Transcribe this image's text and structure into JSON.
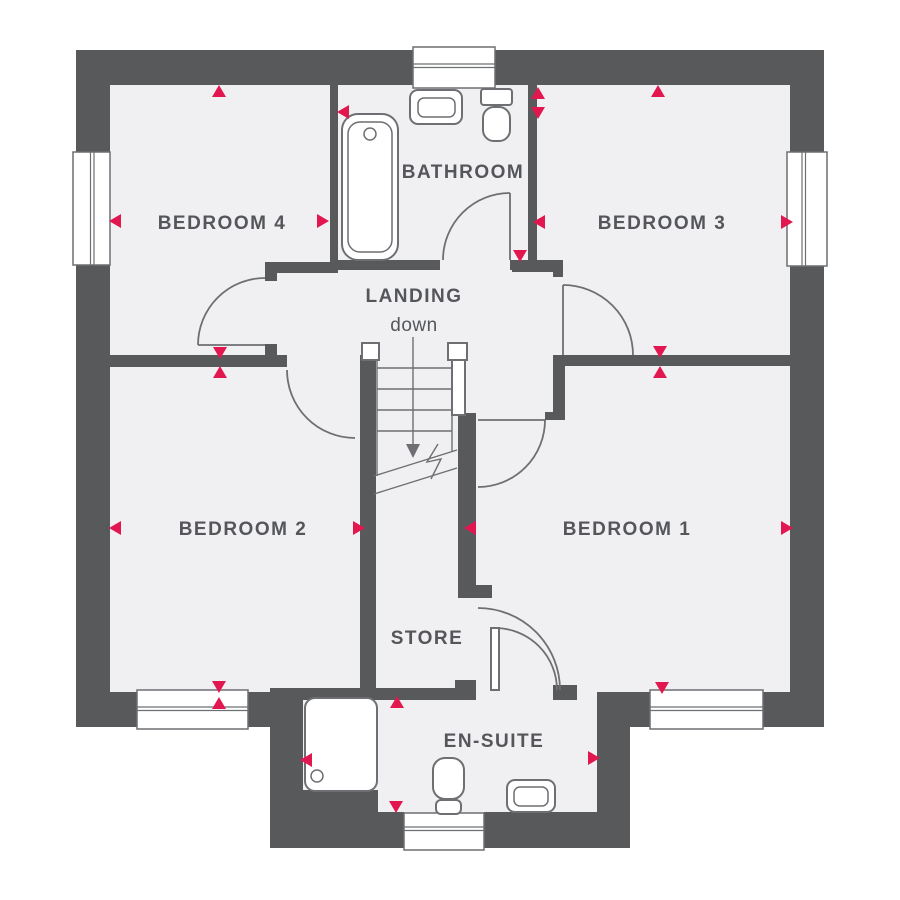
{
  "colors": {
    "wall": "#58595B",
    "floor": "#F0F0F2",
    "line": "#6E6F72",
    "text": "#54565A",
    "accent": "#E3174F",
    "background": "#FFFFFF"
  },
  "rooms": {
    "bedroom4": {
      "label": "BEDROOM 4"
    },
    "bathroom": {
      "label": "BATHROOM"
    },
    "bedroom3": {
      "label": "BEDROOM 3"
    },
    "landing": {
      "label": "LANDING"
    },
    "bedroom2": {
      "label": "BEDROOM 2"
    },
    "bedroom1": {
      "label": "BEDROOM 1"
    },
    "store": {
      "label": "STORE"
    },
    "ensuite": {
      "label": "EN-SUITE"
    }
  },
  "stairs": {
    "direction_label": "down"
  },
  "fixtures": {
    "bathroom": [
      "bathtub",
      "washbasin",
      "toilet"
    ],
    "ensuite": [
      "shower-tray",
      "toilet",
      "washbasin"
    ]
  },
  "windows": [
    "bedroom4-left",
    "bathroom-top",
    "bedroom3-right",
    "bedroom2-bottom",
    "bedroom1-bottom",
    "ensuite-bottom"
  ],
  "dimension_arrows": [
    {
      "x": 219,
      "y": 92,
      "dir": "up"
    },
    {
      "x": 116,
      "y": 221,
      "dir": "left"
    },
    {
      "x": 322,
      "y": 221,
      "dir": "right"
    },
    {
      "x": 220,
      "y": 352,
      "dir": "down"
    },
    {
      "x": 220,
      "y": 373,
      "dir": "up"
    },
    {
      "x": 344,
      "y": 112,
      "dir": "left"
    },
    {
      "x": 538,
      "y": 94,
      "dir": "up"
    },
    {
      "x": 538,
      "y": 112,
      "dir": "down"
    },
    {
      "x": 520,
      "y": 255,
      "dir": "down"
    },
    {
      "x": 658,
      "y": 92,
      "dir": "up"
    },
    {
      "x": 540,
      "y": 222,
      "dir": "left"
    },
    {
      "x": 786,
      "y": 222,
      "dir": "right"
    },
    {
      "x": 660,
      "y": 351,
      "dir": "down"
    },
    {
      "x": 660,
      "y": 373,
      "dir": "up"
    },
    {
      "x": 116,
      "y": 528,
      "dir": "left"
    },
    {
      "x": 358,
      "y": 528,
      "dir": "right"
    },
    {
      "x": 219,
      "y": 686,
      "dir": "down"
    },
    {
      "x": 219,
      "y": 704,
      "dir": "up"
    },
    {
      "x": 471,
      "y": 528,
      "dir": "left"
    },
    {
      "x": 786,
      "y": 528,
      "dir": "right"
    },
    {
      "x": 662,
      "y": 687,
      "dir": "down"
    },
    {
      "x": 397,
      "y": 703,
      "dir": "up"
    },
    {
      "x": 396,
      "y": 806,
      "dir": "down"
    },
    {
      "x": 307,
      "y": 760,
      "dir": "left"
    },
    {
      "x": 593,
      "y": 758,
      "dir": "right"
    }
  ]
}
